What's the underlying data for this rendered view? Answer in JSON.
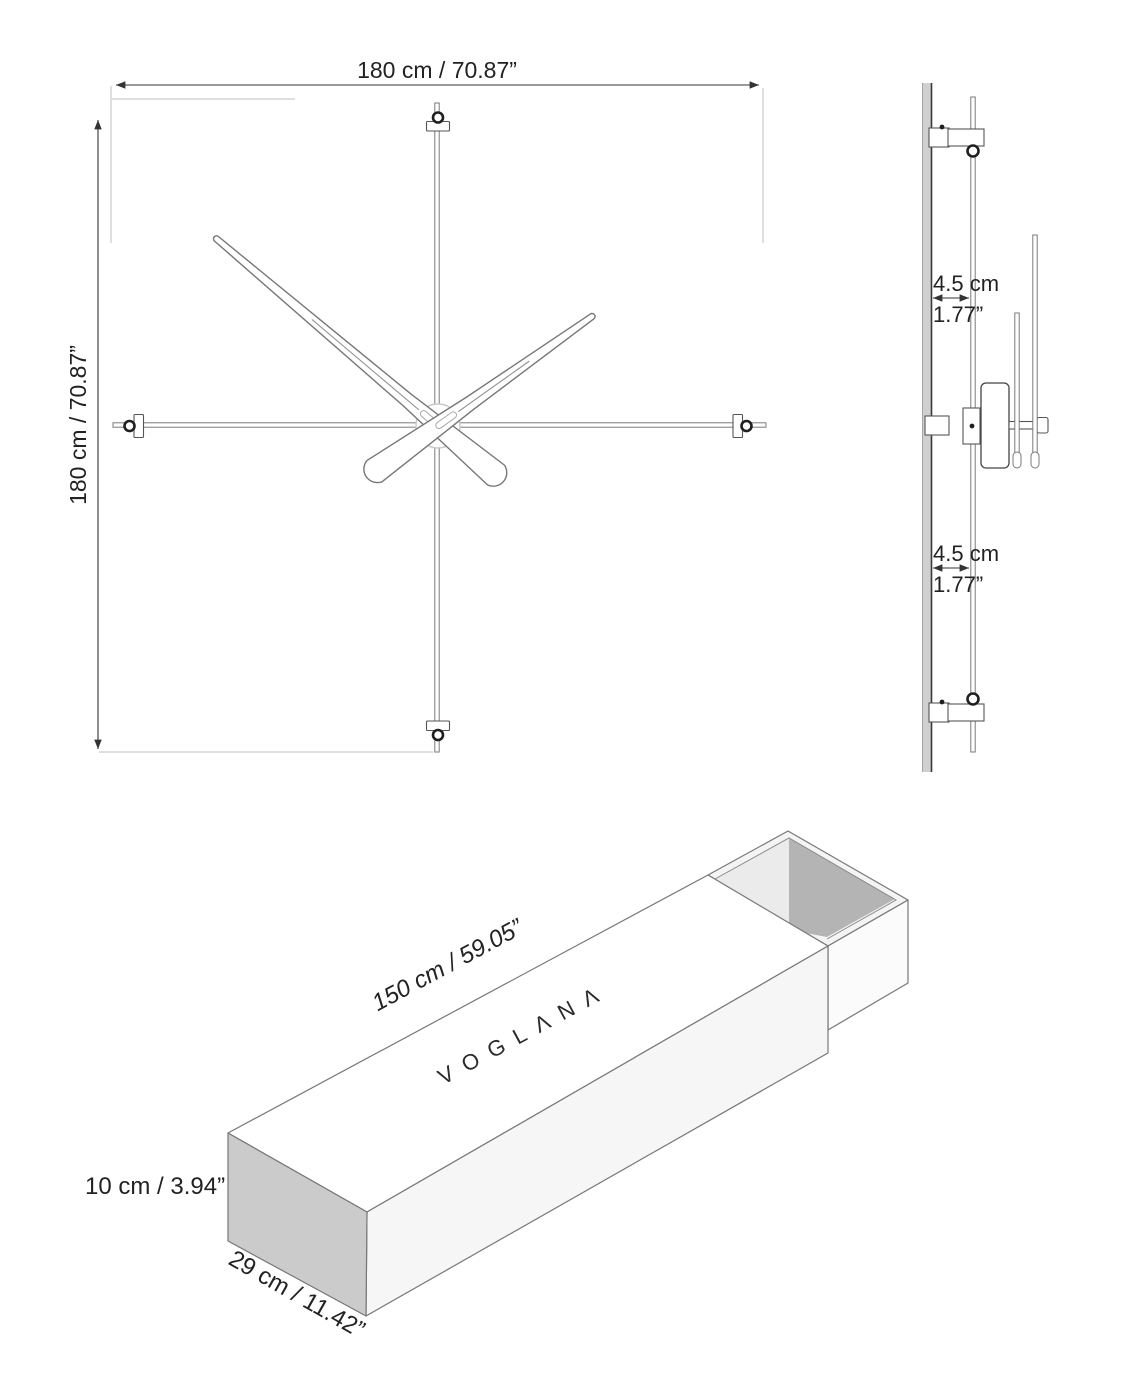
{
  "front_view": {
    "width_label": "180 cm / 70.87”",
    "height_label": "180 cm / 70.87”"
  },
  "side_view": {
    "top_depth_cm": "4.5 cm",
    "top_depth_in": "1.77”",
    "bottom_depth_cm": "4.5 cm",
    "bottom_depth_in": "1.77”"
  },
  "box_view": {
    "brand": "VOGLΛNΛ",
    "length_label": "150 cm / 59.05”",
    "height_label": "10 cm / 3.94”",
    "depth_label": "29 cm / 11.42”"
  },
  "colors": {
    "dimension_line": "#333333",
    "drawing_line": "#6f6f6f",
    "wall_gray": "#d0d0d0",
    "box_left_face": "#cbcbcb",
    "box_front_face": "#f6f6f6",
    "box_top_face": "#ffffff",
    "tray_inner_dark": "#b4b4b4",
    "tray_inner_light": "#ebebeb"
  }
}
